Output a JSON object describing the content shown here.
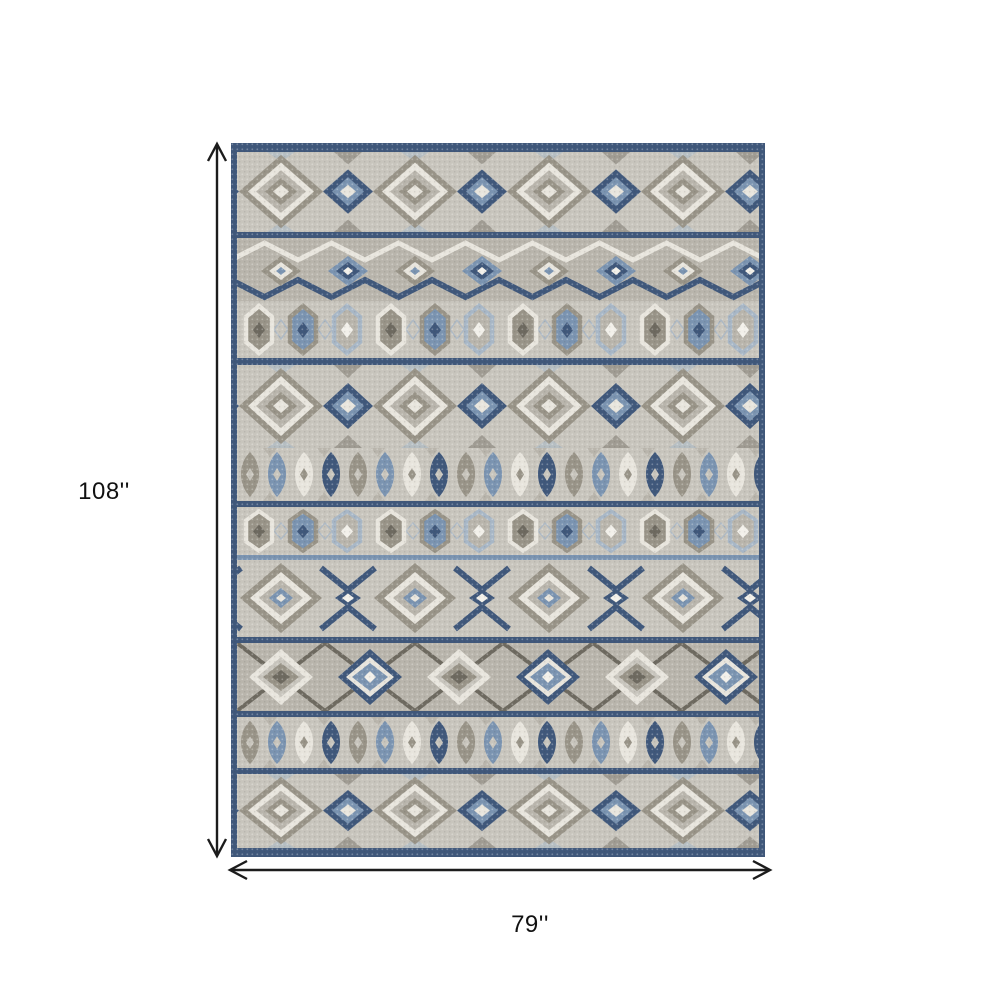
{
  "page": {
    "background": "#ffffff"
  },
  "product_diagram": {
    "height_label": "108''",
    "width_label": "79''"
  },
  "palette": {
    "page-bg": "#ffffff",
    "arrow": "#1c1c1c",
    "label": "#111111",
    "navy": "#40587b",
    "navy-dark": "#354966",
    "steel": "#7b94b1",
    "steel-light": "#a8b7c6",
    "cream": "#e8e5dd",
    "white": "#f2f0ea",
    "taupe": "#999488",
    "gray-dark": "#6e6a60",
    "bg-light": "#c8c5bd",
    "bg-mid": "#b9b5ac"
  }
}
